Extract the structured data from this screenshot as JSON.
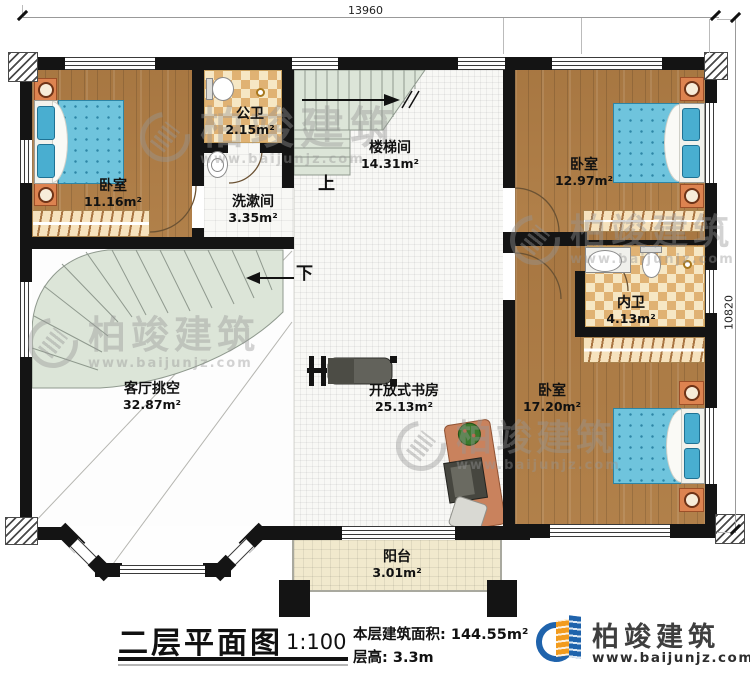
{
  "plan": {
    "dimensions": {
      "width_label": "13960",
      "height_label": "10820"
    },
    "rooms": {
      "bedroom_nw": {
        "name": "卧室",
        "area": "11.16m²"
      },
      "public_bath": {
        "name": "公卫",
        "area": "2.15m²"
      },
      "washroom": {
        "name": "洗漱间",
        "area": "3.35m²"
      },
      "stairwell": {
        "name": "楼梯间",
        "area": "14.31m²"
      },
      "bedroom_ne": {
        "name": "卧室",
        "area": "12.97m²"
      },
      "ensuite_bath": {
        "name": "内卫",
        "area": "4.13m²"
      },
      "bedroom_se": {
        "name": "卧室",
        "area": "17.20m²"
      },
      "living_void": {
        "name": "客厅挑空",
        "area": "32.87m²"
      },
      "open_study": {
        "name": "开放式书房",
        "area": "25.13m²"
      },
      "balcony": {
        "name": "阳台",
        "area": "3.01m²"
      }
    },
    "stairs": {
      "up": "上",
      "down": "下"
    }
  },
  "title_block": {
    "title": "二层平面图",
    "scale": "1:100",
    "floor_area_label": "本层建筑面积:",
    "floor_area_value": "144.55m²",
    "floor_height_label": "层高:",
    "floor_height_value": "3.3m"
  },
  "brand": {
    "name": "柏竣建筑",
    "website": "www.baijunjz.com"
  },
  "watermark": {
    "text": "柏竣建筑",
    "website": "www.baijunjz.com"
  },
  "colors": {
    "wall": "#141414",
    "wood": "#b2824c",
    "checker": "#e0b273",
    "stair_green": "#dce5d8",
    "bed_blue": "#6fc4dd",
    "brand_blue": "#1f63ac",
    "brand_orange": "#f29b1d"
  }
}
